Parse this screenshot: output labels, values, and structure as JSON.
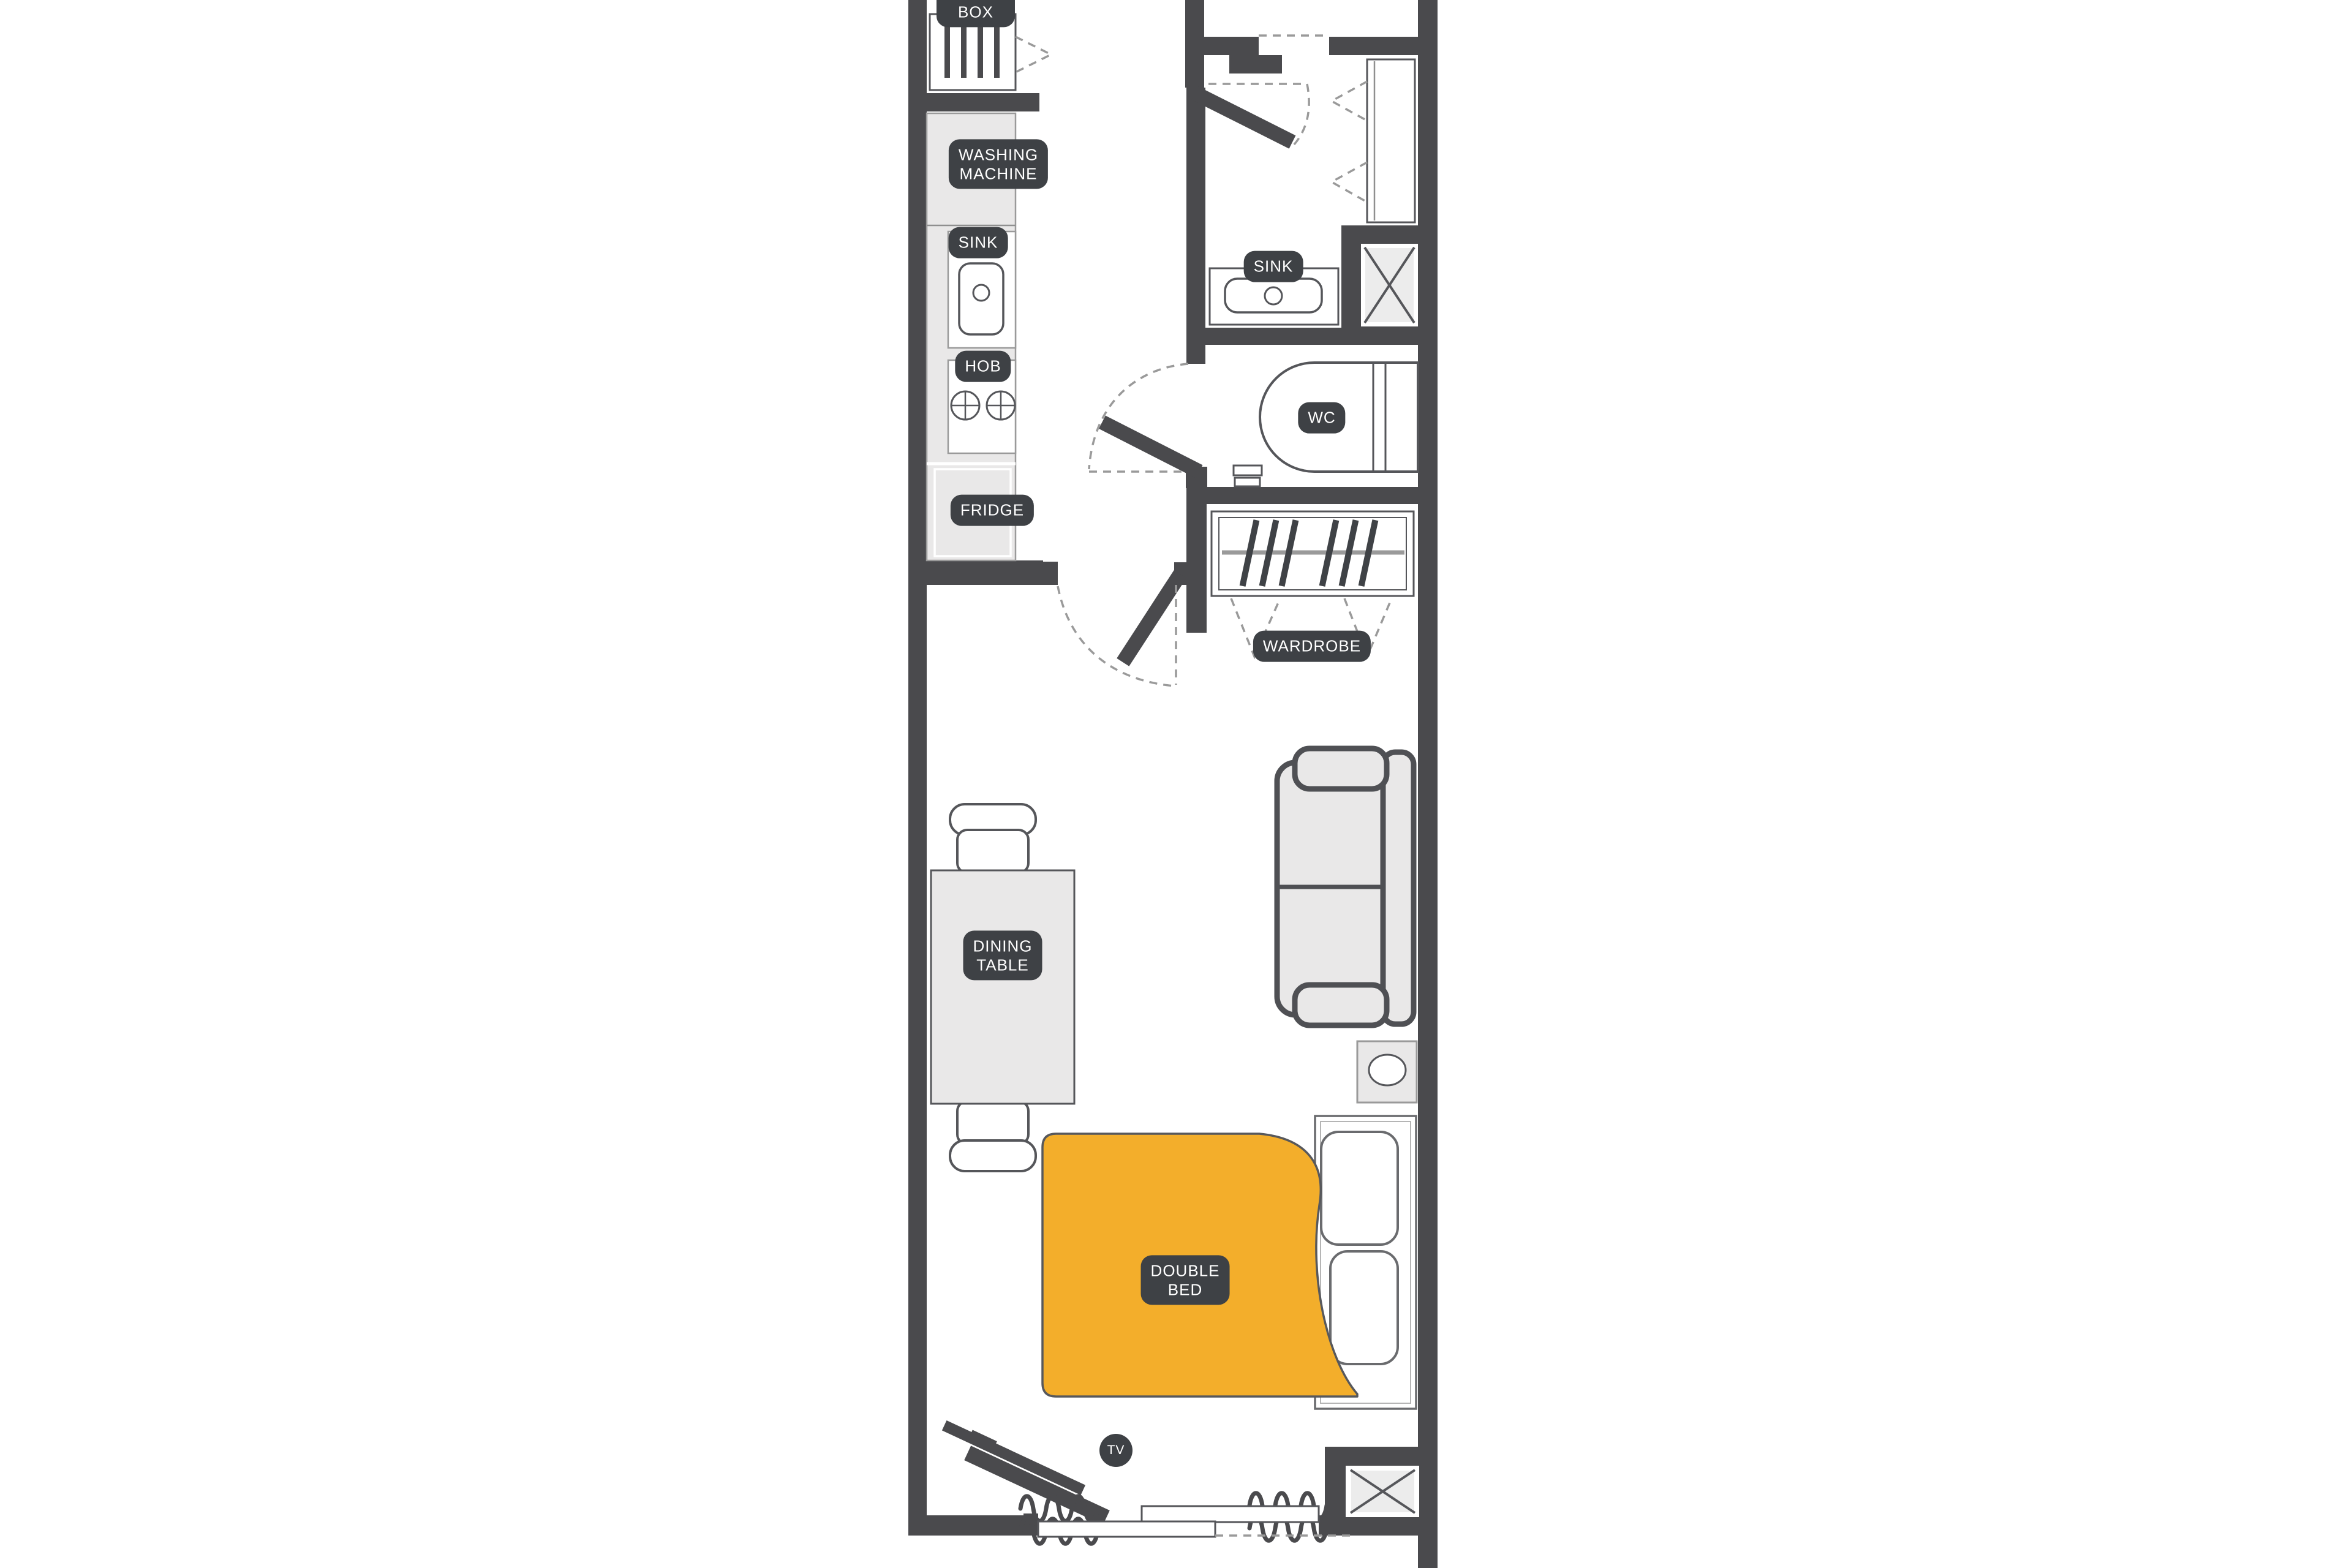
{
  "title": "Studio apartment floor plan",
  "colors": {
    "wall": "#4a4a4d",
    "label_bg": "#3e4145",
    "label_text": "#ffffff",
    "fill_light": "#e9e8e8",
    "blanket_yellow": "#f3ae2b",
    "dash_gray": "#9a9a9a",
    "outline_gray": "#55565a",
    "background": "#ffffff"
  },
  "labels": {
    "shoes_box": "SHOES\nBOX",
    "washing_machine": "WASHING\nMACHINE",
    "kitchen_sink": "SINK",
    "hob": "HOB",
    "fridge": "FRIDGE",
    "bath_sink": "SINK",
    "wc": "WC",
    "wardrobe": "WARDROBE",
    "dining_table": "DINING\nTABLE",
    "double_bed": "DOUBLE\nBED",
    "tv": "TV"
  },
  "items": [
    "shoes-box-cabinet",
    "washing-machine",
    "kitchen-counter",
    "kitchen-sink-basin",
    "hob-burners",
    "fridge",
    "entry-door",
    "entry-tall-cabinet",
    "bathroom-sink-vanity",
    "duct-shaft-bathroom",
    "wc-toilet",
    "toilet-paper-holder",
    "bathroom-door",
    "wardrobe-with-hangers",
    "living-room-door",
    "dining-table",
    "dining-chair-top",
    "dining-chair-bottom",
    "sofa-two-seater",
    "nightstand-with-lamp",
    "double-bed-frame",
    "bed-pillow-left",
    "bed-pillow-right",
    "yellow-blanket-with-fold",
    "tv-on-stand",
    "radiator-squiggle-left",
    "radiator-squiggle-right",
    "sliding-window",
    "duct-shaft-bottom"
  ]
}
